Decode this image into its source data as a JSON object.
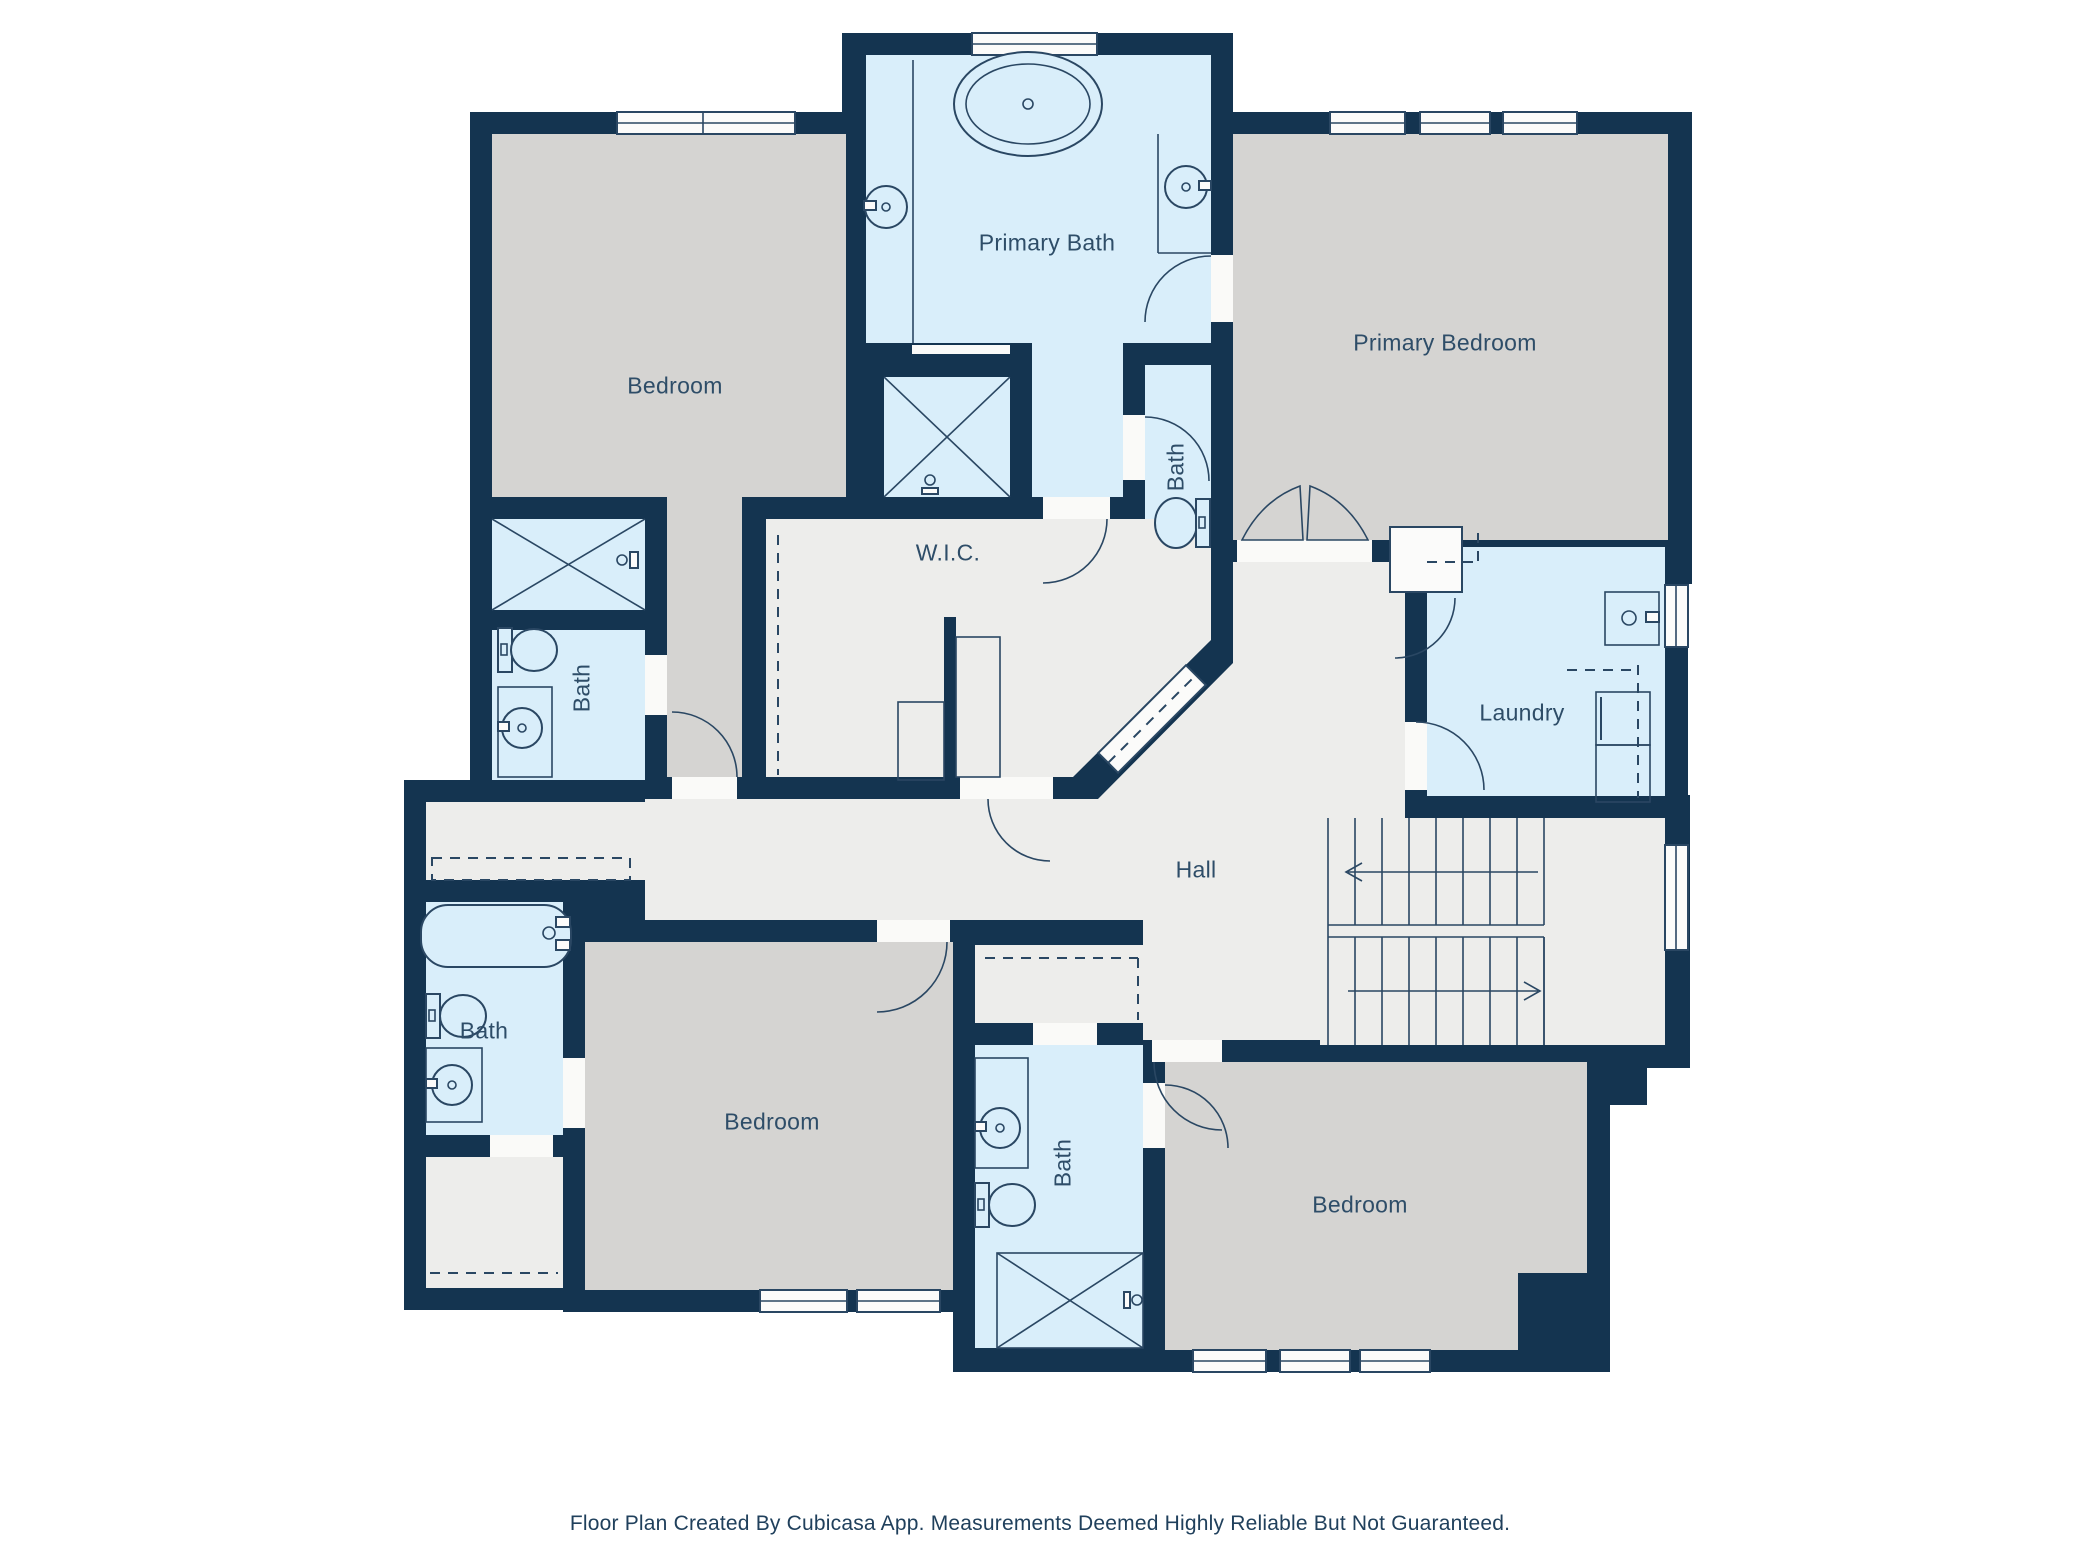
{
  "rooms": {
    "primary_bath": {
      "label": "Primary Bath"
    },
    "primary_bedroom": {
      "label": "Primary Bedroom"
    },
    "bedroom_top_left": {
      "label": "Bedroom"
    },
    "wic": {
      "label": "W.I.C."
    },
    "bath_wc": {
      "label": "Bath"
    },
    "laundry": {
      "label": "Laundry"
    },
    "hall": {
      "label": "Hall"
    },
    "bath_middle_left": {
      "label": "Bath"
    },
    "bath_bottom_left": {
      "label": "Bath"
    },
    "bedroom_bottom_center": {
      "label": "Bedroom"
    },
    "bath_bottom_center": {
      "label": "Bath"
    },
    "bedroom_bottom_right": {
      "label": "Bedroom"
    }
  },
  "footer": {
    "text": "Floor Plan Created By Cubicasa App. Measurements Deemed Highly Reliable But Not Guaranteed."
  },
  "colors": {
    "wall": "#143450",
    "room_blue": "#D9EEFA",
    "room_gray": "#D5D4D2",
    "room_light": "#EDEDEB",
    "stroke": "#2A4763",
    "label": "#2E4D68"
  }
}
